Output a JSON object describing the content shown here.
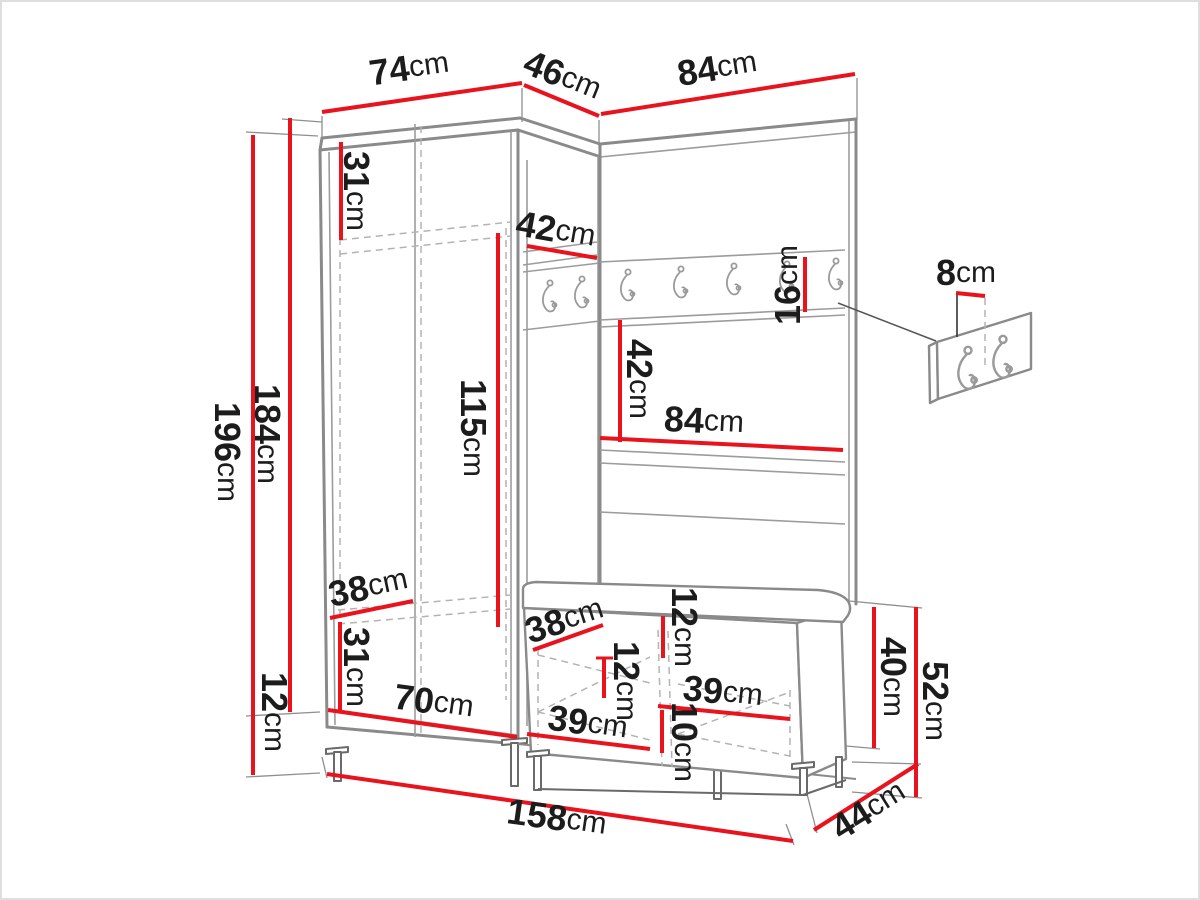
{
  "diagram": {
    "type": "furniture-dimension-diagram",
    "subject": "Hallway furniture set: corner wardrobe with coat-hook panel and shoe bench, annotated with dimensions",
    "unit": "cm",
    "colors": {
      "dimension_line": "#e8131d",
      "outline": "#8a8a8a",
      "dashed": "#b3b3b3",
      "label_text": "#1c1c1c",
      "background": "#ffffff"
    },
    "icons": [
      "coat-hook-icon"
    ]
  },
  "dimensions": {
    "wardrobe_top_width": {
      "value": "74",
      "unit": "cm"
    },
    "corner_top_width": {
      "value": "46",
      "unit": "cm"
    },
    "panel_top_width": {
      "value": "84",
      "unit": "cm"
    },
    "wardrobe_top_section_height": {
      "value": "31",
      "unit": "cm"
    },
    "corner_shelf_depth": {
      "value": "42",
      "unit": "cm"
    },
    "hook_rail_height": {
      "value": "16",
      "unit": "cm"
    },
    "hook_spacing": {
      "value": "8",
      "unit": "cm"
    },
    "panel_rail_to_shelf": {
      "value": "42",
      "unit": "cm"
    },
    "panel_shelf_width": {
      "value": "84",
      "unit": "cm"
    },
    "wardrobe_interior_height": {
      "value": "115",
      "unit": "cm"
    },
    "total_height": {
      "value": "196",
      "unit": "cm"
    },
    "carcass_height": {
      "value": "184",
      "unit": "cm"
    },
    "leg_height": {
      "value": "12",
      "unit": "cm"
    },
    "wardrobe_depth": {
      "value": "38",
      "unit": "cm"
    },
    "wardrobe_bottom_section_height": {
      "value": "31",
      "unit": "cm"
    },
    "wardrobe_interior_width": {
      "value": "70",
      "unit": "cm"
    },
    "bench_inner_depth": {
      "value": "38",
      "unit": "cm"
    },
    "bench_top_offset": {
      "value": "12",
      "unit": "cm"
    },
    "bench_cushion_height": {
      "value": "12",
      "unit": "cm"
    },
    "bench_compartment_width_left": {
      "value": "39",
      "unit": "cm"
    },
    "bench_compartment_width_right": {
      "value": "39",
      "unit": "cm"
    },
    "bench_leg_height": {
      "value": "10",
      "unit": "cm"
    },
    "bench_body_height": {
      "value": "40",
      "unit": "cm"
    },
    "bench_total_height": {
      "value": "52",
      "unit": "cm"
    },
    "bench_depth": {
      "value": "44",
      "unit": "cm"
    },
    "total_width": {
      "value": "158",
      "unit": "cm"
    }
  }
}
